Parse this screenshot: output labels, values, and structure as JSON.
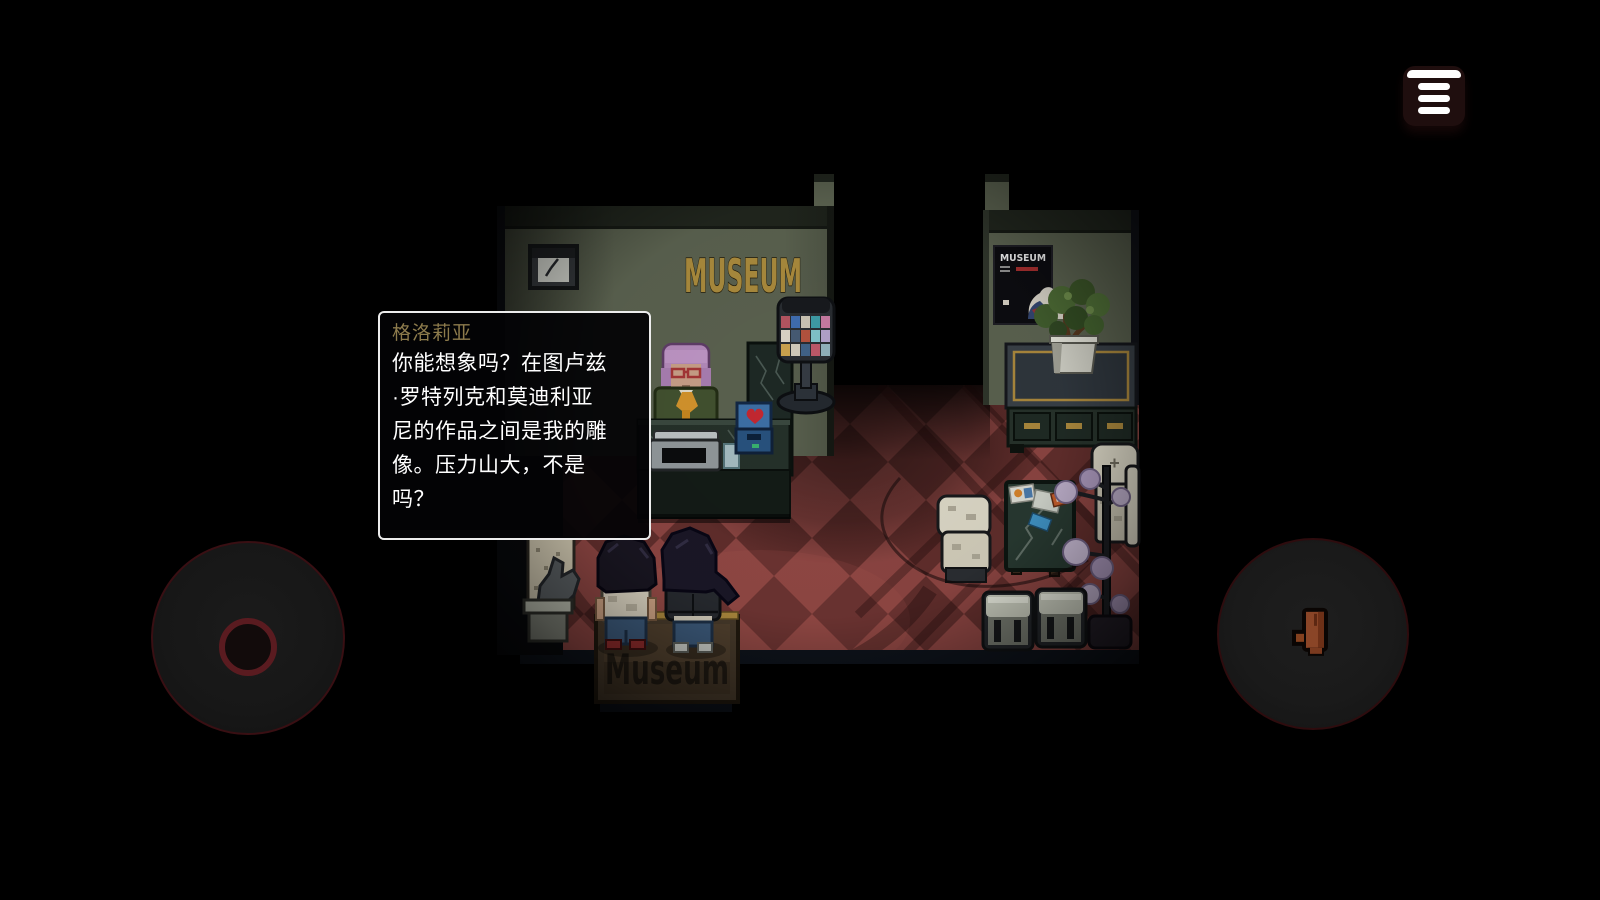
{
  "dialog": {
    "speaker": "格洛莉亚",
    "speaker_color": "#8d7b4c",
    "lines": [
      "你能想象吗？在图卢兹",
      "·罗特列克和莫迪利亚",
      "尼的作品之间是我的雕",
      "像。压力山大，不是",
      "吗？"
    ]
  },
  "scene": {
    "wall_sign_text": "MUSEUM",
    "poster_title": "MUSEUM",
    "doormat_text": "Museum",
    "colors": {
      "wall": "#59604e",
      "floor_tile_light": "#8a4441",
      "floor_tile_dark": "#5f2d2b",
      "sign_gold": "#a8893c",
      "joystick_ring": "#5a1b20",
      "hand_glove": "#8a4527"
    }
  },
  "hud": {
    "menu_button": {
      "icon": "hamburger-menu-icon"
    },
    "joystick": {
      "icon": "virtual-joystick"
    },
    "interact_button": {
      "icon": "hand-glove-icon"
    }
  }
}
